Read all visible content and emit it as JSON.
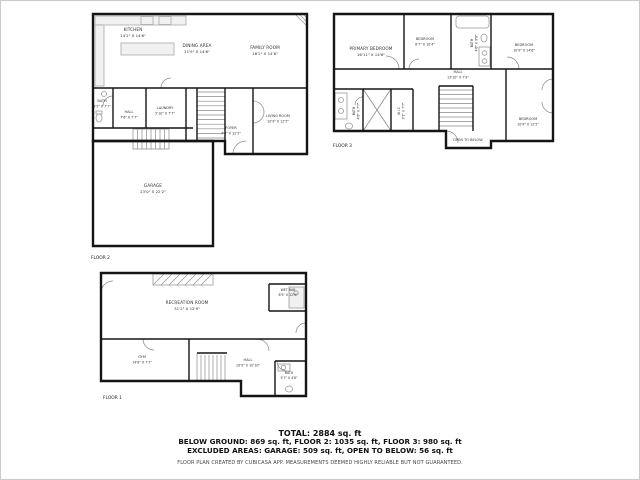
{
  "colors": {
    "wall": "#151515",
    "fixture": "#999999",
    "label_text": "#333333"
  },
  "floor2": {
    "label": "FLOOR 2",
    "rooms": {
      "kitchen": {
        "name": "KITCHEN",
        "dims": "14'2\" X 14'6\""
      },
      "dining": {
        "name": "DINING AREA",
        "dims": "11'9\" X 14'6\""
      },
      "family": {
        "name": "FAMILY ROOM",
        "dims": "16'2\" X 14'6\""
      },
      "bath": {
        "name": "BATH",
        "dims": "3'5\" X 7'7\""
      },
      "hall": {
        "name": "HALL",
        "dims": "7'6\" X 7'7\""
      },
      "laundry": {
        "name": "LAUNDRY",
        "dims": "5'10\" X 7'7\""
      },
      "foyer": {
        "name": "FOYER",
        "dims": "7'8\" X 12'5\""
      },
      "living": {
        "name": "LIVING ROOM",
        "dims": "10'9\" X 12'5\""
      },
      "garage": {
        "name": "GARAGE",
        "dims": "23'0\" X 22'2\""
      }
    }
  },
  "floor3": {
    "label": "FLOOR 3",
    "rooms": {
      "primary": {
        "name": "PRIMARY BEDROOM",
        "dims": "16'11\" X 14'6\""
      },
      "bedroom_top": {
        "name": "BEDROOM",
        "dims": "8'7\" X 10'4\""
      },
      "bath_top": {
        "name": "BATH",
        "dims": "4'6\" X 9'6\""
      },
      "bedroom_right": {
        "name": "BEDROOM",
        "dims": "10'9\" X 14'6\""
      },
      "hall": {
        "name": "HALL",
        "dims": "13'10\" X 7'9\""
      },
      "bath_left": {
        "name": "BATH",
        "dims": "4'6\" X 7'7\""
      },
      "wic": {
        "name": "W.I.C",
        "dims": "3'1\" X 7'7\""
      },
      "bedroom_bottom": {
        "name": "BEDROOM",
        "dims": "10'9\" X 12'5\""
      },
      "open_below": {
        "name": "OPEN TO BELOW"
      }
    }
  },
  "floor1": {
    "label": "FLOOR 1",
    "rooms": {
      "recreation": {
        "name": "RECREATION ROOM",
        "dims": "31'2\" X 12'9\""
      },
      "wetbar": {
        "name": "WET BAR",
        "dims": "8'9\" X 12'9\""
      },
      "gym": {
        "name": "GYM",
        "dims": "14'8\" X 7'7\""
      },
      "hall": {
        "name": "HALL",
        "dims": "10'9\" X 10'10\""
      },
      "bath": {
        "name": "BATH",
        "dims": "5'7\" X 4'8\""
      }
    }
  },
  "summary": {
    "total": "TOTAL: 2884 sq. ft",
    "floors": "BELOW GROUND: 869 sq. ft, FLOOR 2: 1035 sq. ft, FLOOR 3: 980 sq. ft",
    "excluded": "EXCLUDED AREAS: GARAGE: 509 sq. ft, OPEN TO BELOW: 56 sq. ft",
    "disclaimer": "FLOOR PLAN CREATED BY CUBICASA APP. MEASUREMENTS DEEMED HIGHLY RELIABLE BUT NOT GUARANTEED."
  }
}
